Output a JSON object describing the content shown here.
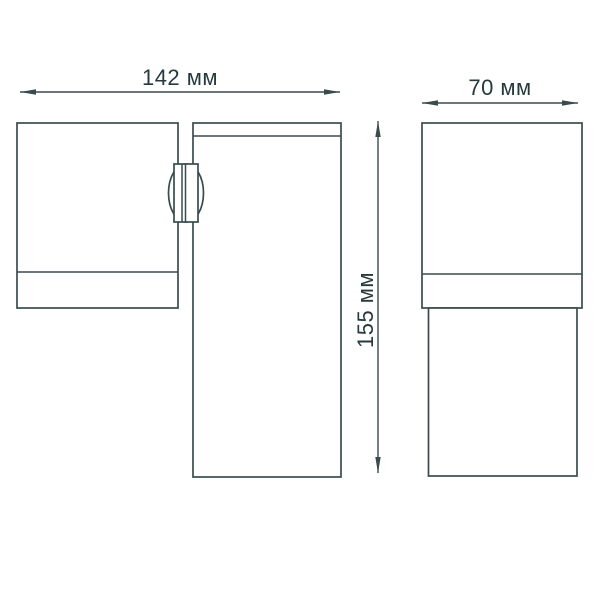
{
  "colors": {
    "background": "#ffffff",
    "stroke": "#3a4b4e",
    "text": "#26393c"
  },
  "dimensions": {
    "front_width": {
      "value": 142,
      "unit": "мм",
      "label": "142 мм"
    },
    "side_width": {
      "value": 70,
      "unit": "мм",
      "label": "70 мм"
    },
    "height": {
      "value": 155,
      "unit": "мм",
      "label": "155 мм"
    }
  }
}
